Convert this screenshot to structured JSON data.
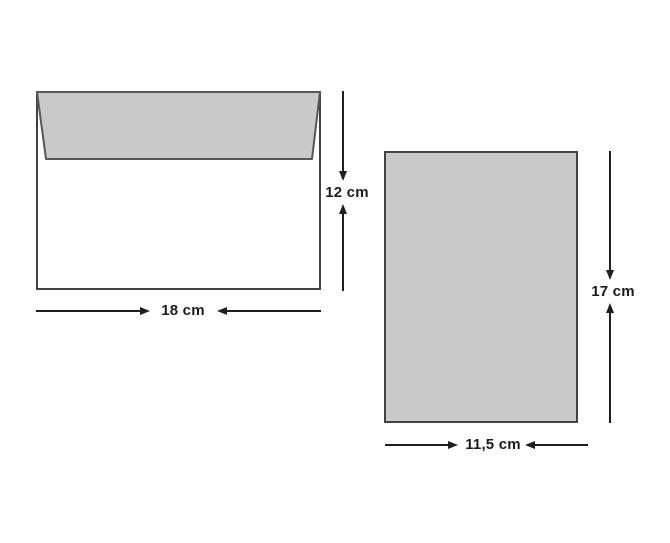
{
  "diagram": {
    "envelope": {
      "height_label": "12 cm",
      "width_label": "18 cm"
    },
    "card": {
      "height_label": "17 cm",
      "width_label": "11,5 cm"
    },
    "colors": {
      "shape_fill": "#c9c9c9",
      "shape_outline": "#424242",
      "flap_stroke": "#575757",
      "dimension_line": "#1f1f1f",
      "label_text": "#1c1c1c",
      "background": "#ffffff"
    }
  }
}
